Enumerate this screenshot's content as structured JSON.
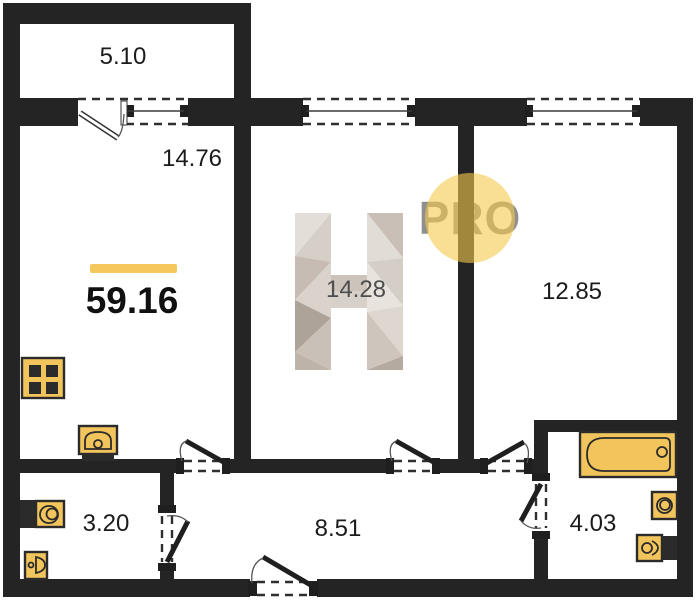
{
  "plan": {
    "title": "apartment-floor-plan",
    "total_area": "59.16",
    "badge": "PRO",
    "rooms": [
      {
        "id": "balcony",
        "area": "5.10"
      },
      {
        "id": "living-room",
        "area": "14.76"
      },
      {
        "id": "center-room",
        "area": "14.28"
      },
      {
        "id": "right-room",
        "area": "12.85"
      },
      {
        "id": "wc-left",
        "area": "3.20"
      },
      {
        "id": "hallway",
        "area": "8.51"
      },
      {
        "id": "bathroom-right",
        "area": "4.03"
      }
    ],
    "colors": {
      "wall": "#242424",
      "fixture_yellow": "#F2C45C",
      "accent_bar": "#F5C85E",
      "badge_fill": "rgba(245,202,75,0.6)",
      "badge_text": "#8f8f8f",
      "watermark_light": "#E4DED8",
      "watermark_dark": "#AEA399"
    }
  }
}
